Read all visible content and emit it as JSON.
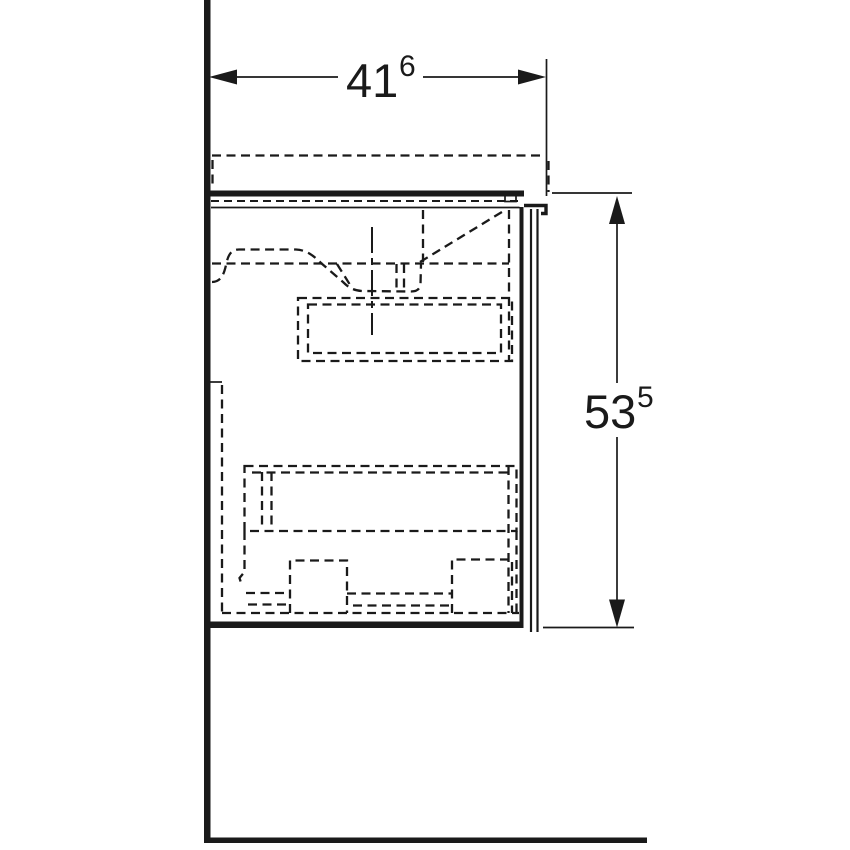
{
  "drawing_type": "side-section technical drawing of wall-hung washbasin vanity cabinet",
  "colors": {
    "line": "#1a1a1a",
    "background": "#ffffff"
  },
  "dimensions": {
    "width": {
      "value": "41",
      "superscript": "6"
    },
    "height": {
      "value": "53",
      "superscript": "5"
    }
  }
}
